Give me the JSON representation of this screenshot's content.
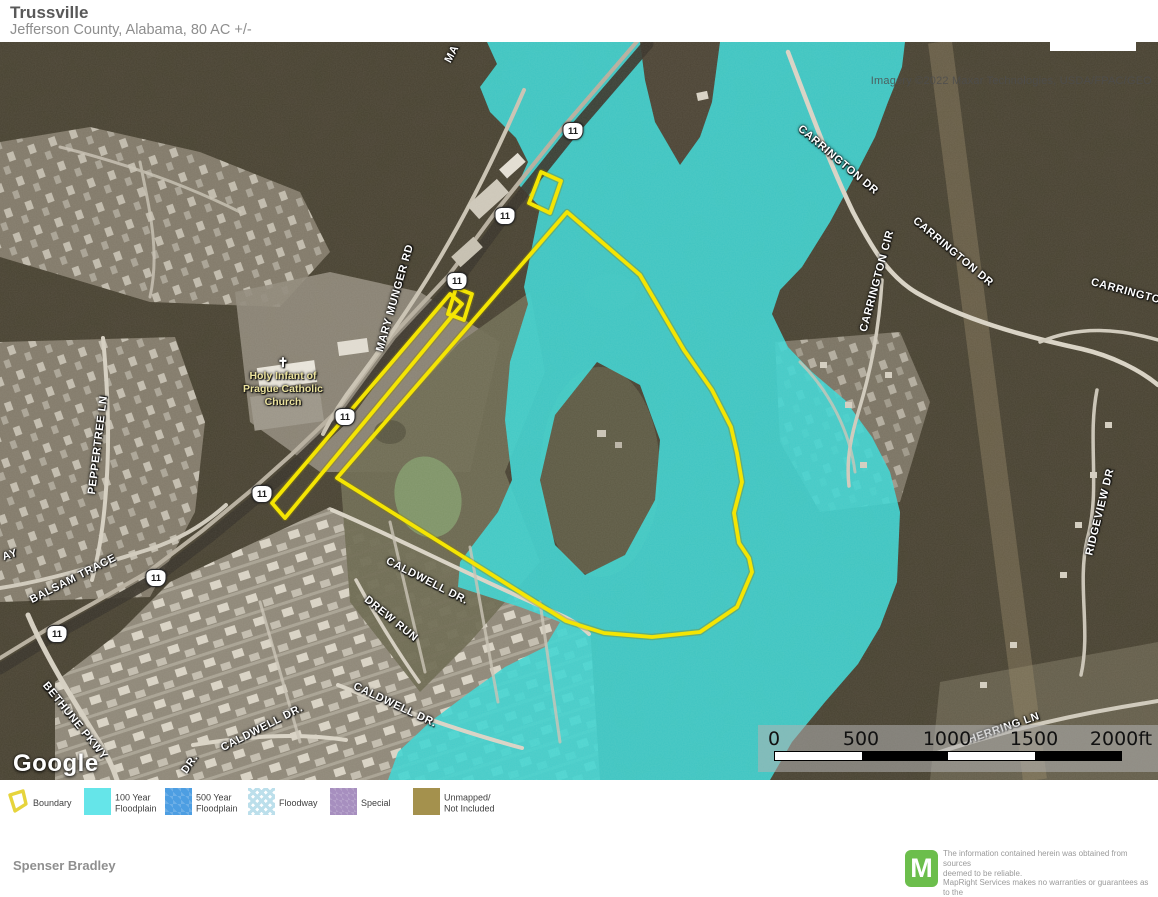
{
  "header": {
    "title": "Trussville",
    "subtitle": "Jefferson County, Alabama, 80 AC +/-"
  },
  "map": {
    "shield": "11",
    "church_lines": [
      "Holy Infant of",
      "Prague Catholic",
      "Church"
    ],
    "labels": [
      {
        "text": "MARY MUNGER RD"
      },
      {
        "text": "CARRINGTON DR"
      },
      {
        "text": "CARRINGTON DR"
      },
      {
        "text": "CARRINGTON CIR"
      },
      {
        "text": "CARRINGTON DR"
      },
      {
        "text": "PEPPERTREE LN"
      },
      {
        "text": "BALSAM TRACE"
      },
      {
        "text": "AY"
      },
      {
        "text": "BETHUNE PKWY"
      },
      {
        "text": "CALDWELL DR."
      },
      {
        "text": "DREW RUN"
      },
      {
        "text": "CALDWELL DR."
      },
      {
        "text": "CALDWELL DR."
      },
      {
        "text": "DR."
      },
      {
        "text": "HERRING LN"
      },
      {
        "text": "RIDGEVIEW DR"
      },
      {
        "text": "MA"
      }
    ],
    "scalebar": {
      "ticks": [
        "0",
        "500",
        "1000",
        "1500",
        "2000ft"
      ]
    },
    "attribution": "Imagery ©2022 Maxar Technologies, USDA/FPAC/GEO",
    "google_logo": "Google"
  },
  "legend": {
    "items": [
      {
        "label": "Boundary",
        "color": "#F2E30B"
      },
      {
        "label": "100 Year\nFloodplain",
        "color": "#65E5E9"
      },
      {
        "label": "500 Year\nFloodplain",
        "color": "#4D9EE2"
      },
      {
        "label": "Floodway",
        "color": "#BCDFEB"
      },
      {
        "label": "Special",
        "color": "#A78FBF"
      },
      {
        "label": "Unmapped/\nNot Included",
        "color": "#A4914D"
      }
    ]
  },
  "footer": {
    "author": "Spenser Bradley",
    "logo_letter": "M",
    "disclaimer": "The information contained herein was obtained from sources\ndeemed to be reliable.\n MapRight Services makes no warranties or guarantees as to the\ncompleteness or accuracy thereof."
  },
  "colors": {
    "flood_overlay": "#3ED4D2",
    "boundary": "#F2E305",
    "mapright_green": "#6CBE4C"
  }
}
